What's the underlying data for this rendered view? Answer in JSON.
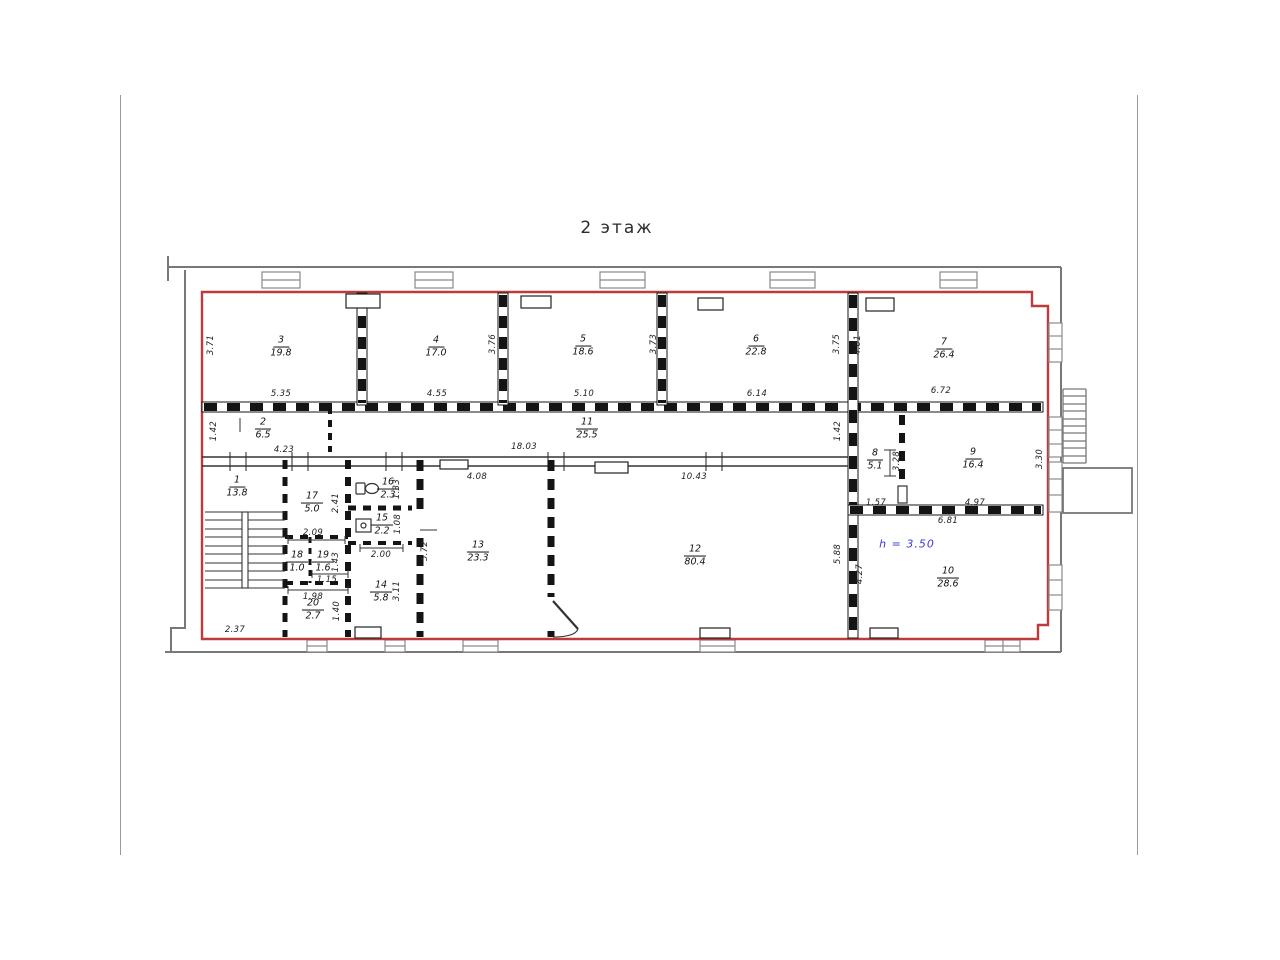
{
  "page": {
    "title": "2 этаж"
  },
  "plan": {
    "height_note": "h = 3.50",
    "rooms": [
      {
        "num": "1",
        "area": "13.8"
      },
      {
        "num": "2",
        "area": "6.5"
      },
      {
        "num": "3",
        "area": "19.8"
      },
      {
        "num": "4",
        "area": "17.0"
      },
      {
        "num": "5",
        "area": "18.6"
      },
      {
        "num": "6",
        "area": "22.8"
      },
      {
        "num": "7",
        "area": "26.4"
      },
      {
        "num": "8",
        "area": "5.1"
      },
      {
        "num": "9",
        "area": "16.4"
      },
      {
        "num": "10",
        "area": "28.6"
      },
      {
        "num": "11",
        "area": "25.5"
      },
      {
        "num": "12",
        "area": "80.4"
      },
      {
        "num": "13",
        "area": "23.3"
      },
      {
        "num": "14",
        "area": "5.8"
      },
      {
        "num": "15",
        "area": "2.2"
      },
      {
        "num": "16",
        "area": "2.3"
      },
      {
        "num": "17",
        "area": "5.0"
      },
      {
        "num": "18",
        "area": "1.0"
      },
      {
        "num": "19",
        "area": "1.6"
      },
      {
        "num": "20",
        "area": "2.7"
      }
    ],
    "dims": {
      "h": [
        "5.35",
        "4.55",
        "5.10",
        "6.14",
        "6.72",
        "4.23",
        "18.03",
        "10.43",
        "4.08",
        "2.09",
        "1.15",
        "1.98",
        "2.00",
        "1.57",
        "4.97",
        "6.81",
        "2.37"
      ],
      "v": [
        "3.71",
        "3.76",
        "3.73",
        "3.75",
        "4.01",
        "1.42",
        "1.42",
        "3.28",
        "3.30",
        "2.41",
        "1.43",
        "1.40",
        "1.33",
        "1.08",
        "3.11",
        "5.72",
        "5.88",
        "4.27"
      ]
    }
  },
  "colors": {
    "outline_red": "#bf3b3b",
    "note_blue": "#3a3ac8",
    "wall_black": "#141414",
    "outer_gray": "#787878"
  }
}
